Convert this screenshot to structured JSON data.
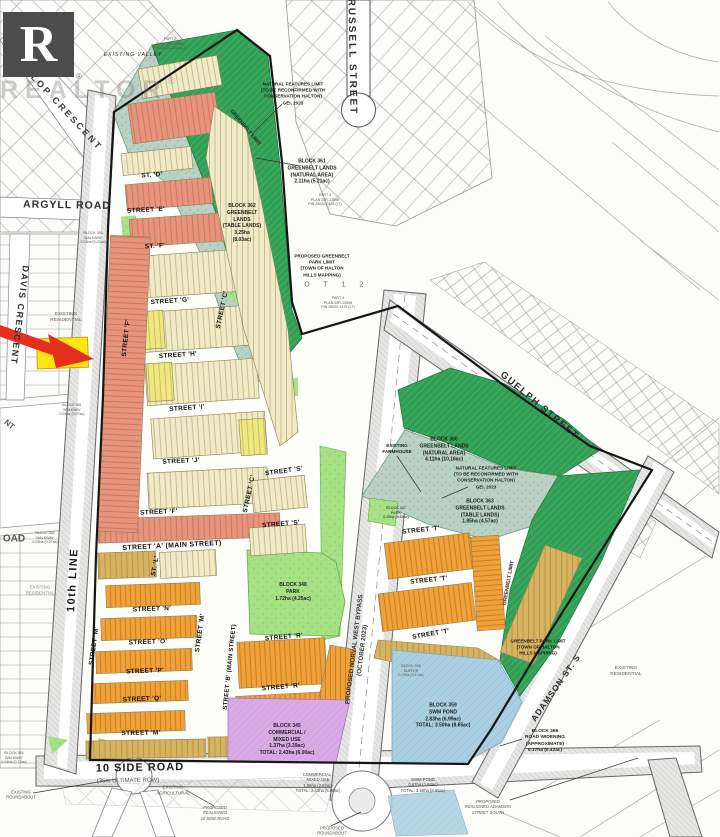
{
  "logo": {
    "letter": "R",
    "wordmark": "REALTOR",
    "registered": "®"
  },
  "colors": {
    "greenbelt_natural": "#319f54",
    "greenbelt_table": "#bad2c3",
    "park": "#a6e284",
    "residential_single": "#f1ebc5",
    "residential_medium": "#e8947c",
    "residential_towns": "#f2a138",
    "residential_frontage": "#d8b35f",
    "commercial": "#daaae7",
    "swm_pond": "#aacfe2",
    "highlight_parcel": "#ffe414",
    "arrow": "#e5301f"
  },
  "roads": {
    "gollop": "GOLLOP CRESCENT",
    "russell": "RUSSELL STREET",
    "argyll": "ARGYLL ROAD",
    "davis": "DAVIS CRESCENT",
    "tenth_line": "10th LINE",
    "ten_side": "10 SIDE ROAD",
    "ultimate_row": "(35m ULTIMATE ROW)",
    "guelph": "GUELPH STREET",
    "adamson": "ADAMSON ST. S",
    "bypass": "PROPOSED NORVAL WEST BYPASS\n(OCTOBER 2023)",
    "oad_fragment": "OAD",
    "nt_fragment": "NT"
  },
  "streets": {
    "a": "STREET 'A' (MAIN STREET)",
    "b": "STREET 'B' (MAIN STREET)",
    "c": "STREET 'C'",
    "d": "ST. 'D'",
    "e": "STREET 'E'",
    "f_short": "ST. 'F'",
    "f": "STREET 'F'",
    "g": "STREET 'G'",
    "h": "STREET 'H'",
    "i": "STREET 'I'",
    "j": "STREET 'J'",
    "l": "ST. 'L'",
    "m": "STREET 'M'",
    "n": "STREET 'N'",
    "o": "STREET 'O'",
    "p": "STREET 'P'",
    "q": "STREET 'Q'",
    "r": "STREET 'R'",
    "s": "STREET 'S'",
    "t": "STREET 'T'"
  },
  "blocks": {
    "block361": "BLOCK 361\nGREENBELT LANDS\n(NATURAL AREA)\n2.11ha (5.21ac)",
    "block362": "BLOCK 362\nGREENBELT\nLANDS\n(TABLE LANDS)\n3.25ha\n(8.03ac)",
    "block360": "BLOCK 360\nGREENBELT LANDS\n(NATURAL AREA)\n4.11ha (10.16ac)",
    "block363": "BLOCK 363\nGREENBELT LANDS\n(TABLE LANDS)\n1.85ha (4.57ac)",
    "block348": "BLOCK 348\nPARK\n1.72ha (4.25ac)",
    "block347": "BLOCK 347\nPARK\n0.26ha (0.64ac)",
    "block345": "BLOCK 345\nCOMMERCIAL /\nMIXED USE\n1.37ha (3.39ac)\nTOTAL: 2.43ha (6.00ac)",
    "commercial_south": "COMMERCIAL /\nMIXED USE\n1.06ha (2.62ac)\nTOTAL: 2.43ha (6.00ac)",
    "block359": "BLOCK 359\nSWM POND\n2.83ha (6.99ac)\nTOTAL: 3.50ha (8.65ac)",
    "swm_south": "SWM POND\n0.67ha (1.66ac)\nTOTAL: 3.50ha (8.65ac)",
    "block358": "BLOCK 358\nBUFFER\n0.07ha (0.17ac)",
    "block366": "BLOCK 366\nROAD WIDENING\n(APPROXIMATE)\n0.17ha (0.42ac)",
    "walkway_a": "BLOCK 353\nWALKWAY\n0.03ha (0.07ac)",
    "walkway_b": "BLOCK 351\nWALKWAY\n0.03ha (0.07ac)",
    "walkway_c": "BLOCK 352\nWALKWAY\n0.03ha (0.07ac)",
    "walkway_d": "BLOCK 364\nWALKWAY\n0.04ha (0.10ac)"
  },
  "notes": {
    "natural_features": "NATURAL FEATURES LIMIT\n(TO BE RECONFIRMED WITH\nCONSERVATION HALTON)\nGEI, 2023",
    "greenbelt_limit": "GREENBELT LIMIT",
    "park_limit_top": "PROPOSED GREENBELT PARK LIMIT\n(TOWN OF HALTON\nHILLS MAPPING)",
    "park_limit_right": "GREENBELT PARK LIMIT\n(TOWN OF HALTON\nHILLS MAPPING)",
    "existing_valley": "EXISTING VALLEY",
    "existing_residential": "EXISTING\nRESIDENTIAL",
    "existing_agricultural": "EXISTING\nAGRICULTURAL",
    "existing_farmhouse": "EXISTING\nFARMHOUSE",
    "existing_roundabout": "EXISTING\nROUNDABOUT",
    "proposed_roundabout": "PROPOSED\nROUNDABOUT",
    "realigned_10side": "PROPOSED\nREALIGNED\n10 SIDE ROAD",
    "realigned_adamson": "PROPOSED\nREALIGNED ADAMSON\nSTREET SOUTH",
    "part2": "PART 2\nPLAN 20R-12595\nPIN 25020-0424 (LT)",
    "part3": "PART 3\nPLAN 20R-12595\nPIN 25020-0424 (LT)",
    "part4": "PART 4\nPLAN 20R-12595\nPIN 25020-1475 (LT)",
    "lot12": "L O T   1 2"
  }
}
